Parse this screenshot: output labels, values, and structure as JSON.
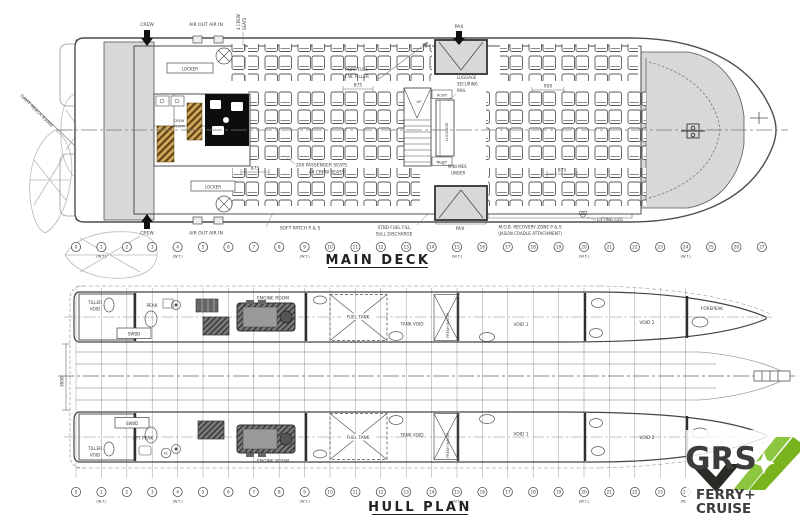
{
  "main_deck": {
    "title": "MAIN DECK",
    "wt_label": "(W.T.)",
    "stations": [
      "0",
      "1",
      "2",
      "3",
      "4",
      "5",
      "6",
      "7",
      "8",
      "9",
      "10",
      "11",
      "12",
      "13",
      "14",
      "15",
      "16",
      "17",
      "18",
      "19",
      "20",
      "21",
      "22",
      "23",
      "24",
      "25",
      "26",
      "27"
    ],
    "wt_stations": [
      1,
      4,
      9,
      15,
      20,
      24
    ],
    "labels": {
      "crew_top": "CREW",
      "crew_bottom": "CREW",
      "air_out_in_top": "AIR OUT AIR IN",
      "air_out_in_bottom": "AIR OUT AIR IN",
      "crew_seats_l1": "4 CREW",
      "crew_seats_l2": "SEATS",
      "port_fuel_l1": "PORT FUEL",
      "port_fuel_l2": "F.W. FILLER",
      "pax_top": "PAX",
      "pax_bottom": "PAX",
      "luggage_rail_l1": "LUGGAGE",
      "luggage_rail_l2": "SECURING",
      "luggage_rail_l3": "RAIL",
      "rcwy_top": "RCWY",
      "rcwy_bottom": "RCWY",
      "up": "UP",
      "luggage_vert": "LUGGAGE",
      "locker_top": "LOCKER",
      "locker_bottom": "LOCKER",
      "crew_room_l1": "CREW",
      "crew_room_l2": "ROOM",
      "mini_mes_l1": "MINI MES",
      "mini_mes_l2": "UNDER",
      "passenger_seats_l1": "200 PASSENGER SEATS",
      "passenger_seats_l2": "+4 CREW SEATS",
      "soft_patch": "SOFT PATCH P & S",
      "stbd_fuel_l1": "STBD FUEL FILL",
      "stbd_fuel_l2": "SULL DISCHARGE",
      "mob_l1": "M.O.B. RECOVERY ZONE P & S",
      "mob_l2": "(JASON CRADLE ATTACHMENT)",
      "lifting_lug": "LIFTING LUG",
      "davit_reach": "DAVIT REACH R3000",
      "vl_top": "V.L.",
      "vl_bottom": "V.L.",
      "dim_875_a": "875",
      "dim_950": "950",
      "dim_875_b": "875",
      "dim_875_c": "875"
    }
  },
  "hull_plan": {
    "title": "HULL PLAN",
    "wt_label": "(W.T.)",
    "stations": [
      "0",
      "1",
      "2",
      "3",
      "4",
      "5",
      "6",
      "7",
      "8",
      "9",
      "10",
      "11",
      "12",
      "13",
      "14",
      "15",
      "16",
      "17",
      "18",
      "19",
      "20",
      "21",
      "22",
      "23",
      "24"
    ],
    "wt_stations": [
      1,
      4,
      9,
      15,
      20,
      24
    ],
    "labels": {
      "tiller_void_l1": "TILLER",
      "tiller_void_l2": "VOID",
      "peak": "PEAK",
      "aft_peak": "AFT PEAK",
      "swbd": "SWBD",
      "engine_room": "ENGINE ROOM",
      "fuel_tank": "FUEL TANK",
      "tank_void": "TANK VOID",
      "fresh_water": "FRESH WATER",
      "void1": "VOID 1",
      "void2": "VOID 2",
      "forepeak": "FOREPEAK",
      "ac": "AC",
      "dim_3000": "3000"
    }
  },
  "logo": {
    "brand": "GRS",
    "line1": "FERRY+",
    "line2": "CRUISE"
  },
  "colors": {
    "drawing_line": "#4d4d4d",
    "shade_gray": "#d8d8d8",
    "hatch_tan": "#d2a95f",
    "logo_green": "#79b41e",
    "logo_green_light": "#8dc63f",
    "logo_dark": "#2b2b26",
    "logo_text_dark": "#3d3d3b"
  }
}
